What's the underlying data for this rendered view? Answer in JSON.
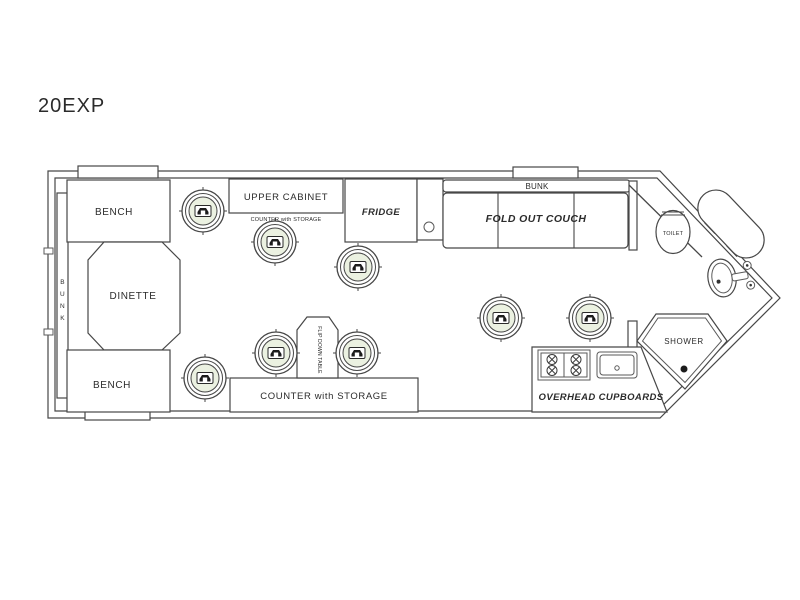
{
  "title": "20EXP",
  "colors": {
    "line": "#474747",
    "hole_fill": "#ebf1e1",
    "text": "#2b2b2b",
    "muted_text": "#7a7a7a",
    "background": "#ffffff"
  },
  "floorplan": {
    "labels": {
      "bench_top": "BENCH",
      "bench_bottom": "BENCH",
      "dinette": "DINETTE",
      "bunk_vertical": [
        "B",
        "U",
        "N",
        "K"
      ],
      "upper_cabinet": "UPPER CABINET",
      "upper_cabinet_note": "COUNTER with STORAGE",
      "fridge": "FRIDGE",
      "bunk_top": "BUNK",
      "fold_out_couch": "FOLD OUT COUCH",
      "toilet": "TOILET",
      "shower": "SHOWER",
      "flip_down_table": "FLIP DOWN TABLE",
      "counter_storage": "COUNTER with STORAGE",
      "overhead_cupboards": "OVERHEAD CUPBOARDS"
    },
    "holes": [
      {
        "x": 203,
        "y": 211
      },
      {
        "x": 275,
        "y": 242
      },
      {
        "x": 358,
        "y": 267
      },
      {
        "x": 501,
        "y": 318
      },
      {
        "x": 590,
        "y": 318
      },
      {
        "x": 276,
        "y": 353
      },
      {
        "x": 357,
        "y": 353
      },
      {
        "x": 205,
        "y": 378
      }
    ]
  }
}
